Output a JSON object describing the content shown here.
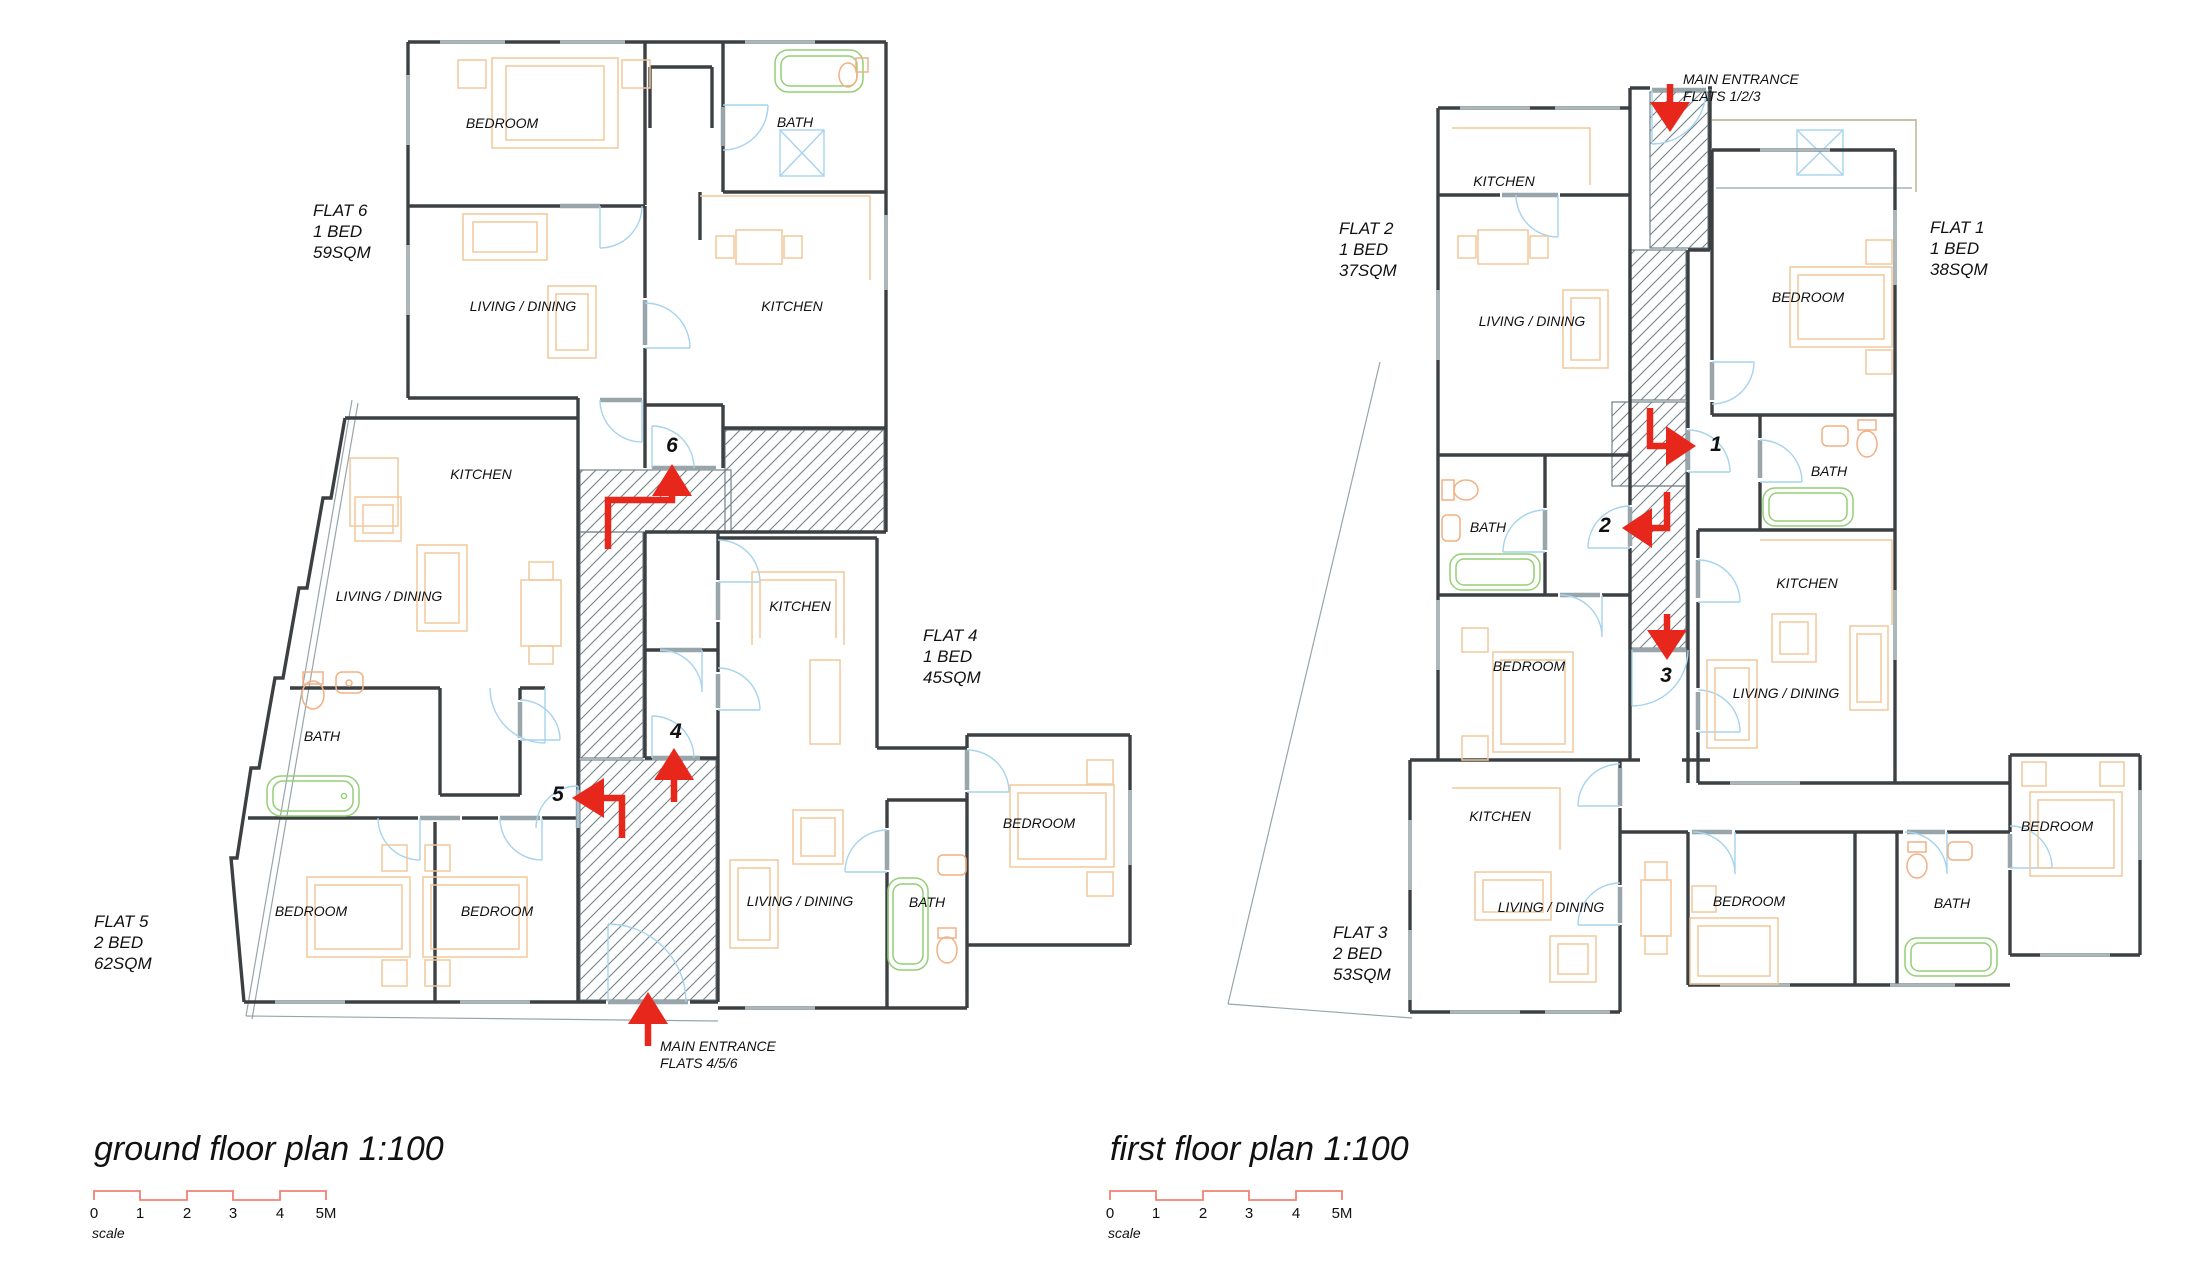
{
  "colors": {
    "background": "#ffffff",
    "wall": "#3d4043",
    "wall_light": "#98a5ab",
    "window": "#aab8bd",
    "door_arc": "#a6d3ee",
    "furniture": "#f2c89c",
    "fixture_green": "#94cf76",
    "fixture_orange": "#f2b083",
    "hatch": "#73828a",
    "arrow_red": "#e8271c",
    "scalebar_red": "#f08273",
    "skylight_blue": "#a6d3ee",
    "roof_line": "#b9ad8a",
    "text": "#111111"
  },
  "titles": {
    "ground": "ground floor plan 1:100",
    "first": "first floor plan 1:100"
  },
  "scale_bar": {
    "ticks": [
      "0",
      "1",
      "2",
      "3",
      "4",
      "5M"
    ],
    "label": "scale"
  },
  "ground": {
    "flats": [
      {
        "name": "FLAT 6",
        "beds": "1 BED",
        "area": "59SQM"
      },
      {
        "name": "FLAT 4",
        "beds": "1 BED",
        "area": "45SQM"
      },
      {
        "name": "FLAT 5",
        "beds": "2 BED",
        "area": "62SQM"
      }
    ],
    "rooms": [
      "BEDROOM",
      "BATH",
      "LIVING / DINING",
      "KITCHEN",
      "KITCHEN",
      "LIVING / DINING",
      "BATH",
      "BEDROOM",
      "BEDROOM",
      "KITCHEN",
      "LIVING / DINING",
      "BATH",
      "BEDROOM"
    ],
    "units": [
      "6",
      "4",
      "5"
    ],
    "entrance": {
      "line1": "MAIN ENTRANCE",
      "line2": "FLATS 4/5/6"
    }
  },
  "first": {
    "flats": [
      {
        "name": "FLAT 2",
        "beds": "1 BED",
        "area": "37SQM"
      },
      {
        "name": "FLAT 1",
        "beds": "1 BED",
        "area": "38SQM"
      },
      {
        "name": "FLAT 3",
        "beds": "2 BED",
        "area": "53SQM"
      }
    ],
    "rooms": [
      "KITCHEN",
      "LIVING / DINING",
      "BATH",
      "BEDROOM",
      "BEDROOM",
      "BATH",
      "KITCHEN",
      "LIVING / DINING",
      "KITCHEN",
      "LIVING / DINING",
      "BEDROOM",
      "BATH",
      "BEDROOM"
    ],
    "units": [
      "1",
      "2",
      "3"
    ],
    "entrance": {
      "line1": "MAIN ENTRANCE",
      "line2": "FLATS 1/2/3"
    }
  }
}
